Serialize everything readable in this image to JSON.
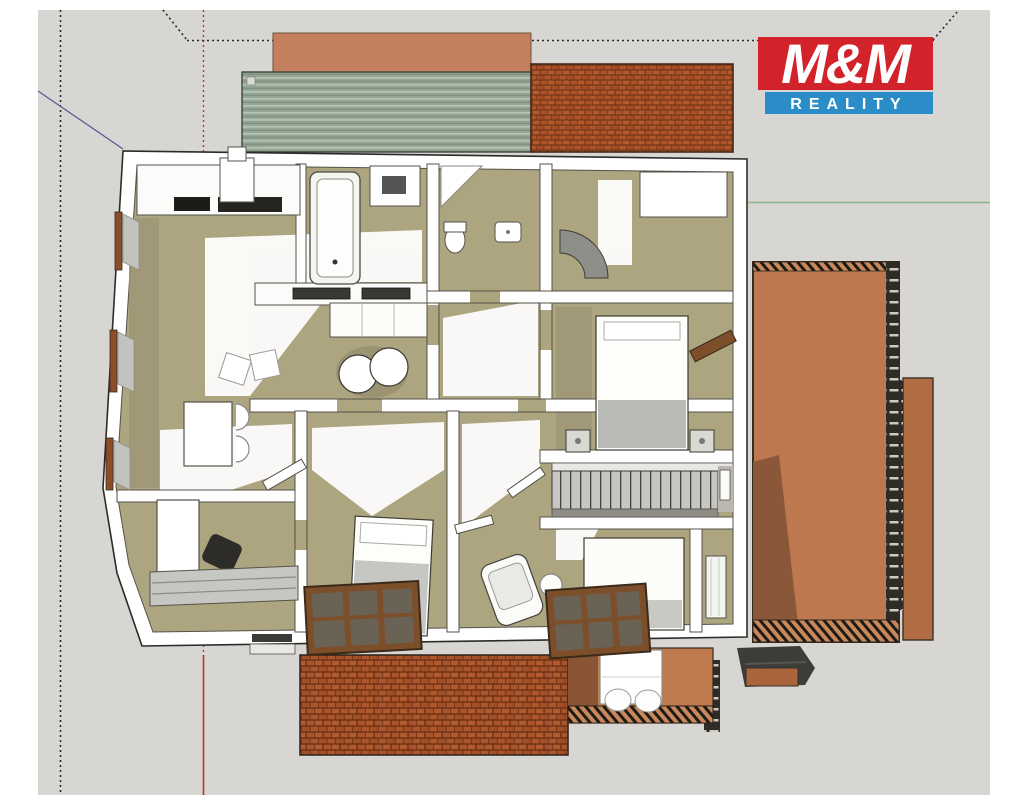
{
  "logo": {
    "line1": "M&M",
    "line2": "REALITY",
    "red": "#d2232a",
    "blue": "#2b8dc8",
    "text_color": "#ffffff"
  },
  "scene": {
    "description": "3D cutaway top-down floor plan render of a house (attic floor) with terraces and tiled roofs",
    "background": "#d7d6d2",
    "margin_color": "#ffffff",
    "colors": {
      "floor_khaki": "#aca57f",
      "floor_shadow": "#9d9574",
      "wall_white": "#ffffff",
      "wall_edge": "#55524a",
      "roof_terracotta": "#bd7850",
      "roof_shadow": "#8a5838",
      "brick_red": "#a8542c",
      "pergola_green": "#96a795",
      "pergola_roof_salmon": "#c4805e",
      "wood_brown": "#7d4e2a",
      "stairs_gray": "#c6c6c3",
      "guide_black": "#2a2a2a",
      "guide_red": "#b03a30",
      "axis_green": "#8cb48c",
      "axis_blue": "#5c5c96",
      "dark_structure": "#3c3c38"
    }
  }
}
